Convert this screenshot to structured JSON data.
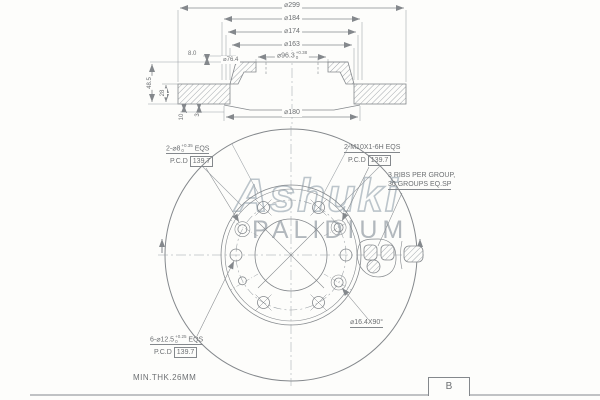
{
  "watermark": {
    "brand": "Ashuki",
    "sub": "PALIDIUM"
  },
  "section": {
    "d_outer": "⌀299",
    "d_hat_outer": "⌀184",
    "d_hat_inner": "⌀174",
    "d_ring_inner": "⌀163",
    "d_bore": "⌀96.3",
    "d_bore_tol_up": "+0.38",
    "d_bore_tol_dn": "0",
    "d_pilot": "⌀76.4",
    "t_flange": "8.0",
    "h_overall": "48.5",
    "t_disc": "28",
    "t_plate": "10",
    "t_slot": "3",
    "d_inner_bottom": "⌀180"
  },
  "front": {
    "dowel_line": "2-⌀8",
    "dowel_tol_up": "+0.35",
    "dowel_tol_dn": "0",
    "dowel_suffix": "EQS",
    "dowel_pcd_label": "P.C.D",
    "dowel_pcd": "139.7",
    "thread_line": "2-M10X1-6H EQS",
    "thread_pcd_label": "P.C.D",
    "thread_pcd": "139.7",
    "ribs1": "3 RIBS PER GROUP,",
    "ribs2": "30 GROUPS EQ.SP",
    "bolt_line": "6-⌀12.5",
    "bolt_tol_up": "+0.25",
    "bolt_tol_dn": "0",
    "bolt_suffix": "EQS",
    "bolt_pcd_label": "P.C.D",
    "bolt_pcd": "139.7",
    "chamfer": "⌀16.4X90°"
  },
  "footer": {
    "note": "MIN.THK.26MM",
    "rev": "B"
  }
}
